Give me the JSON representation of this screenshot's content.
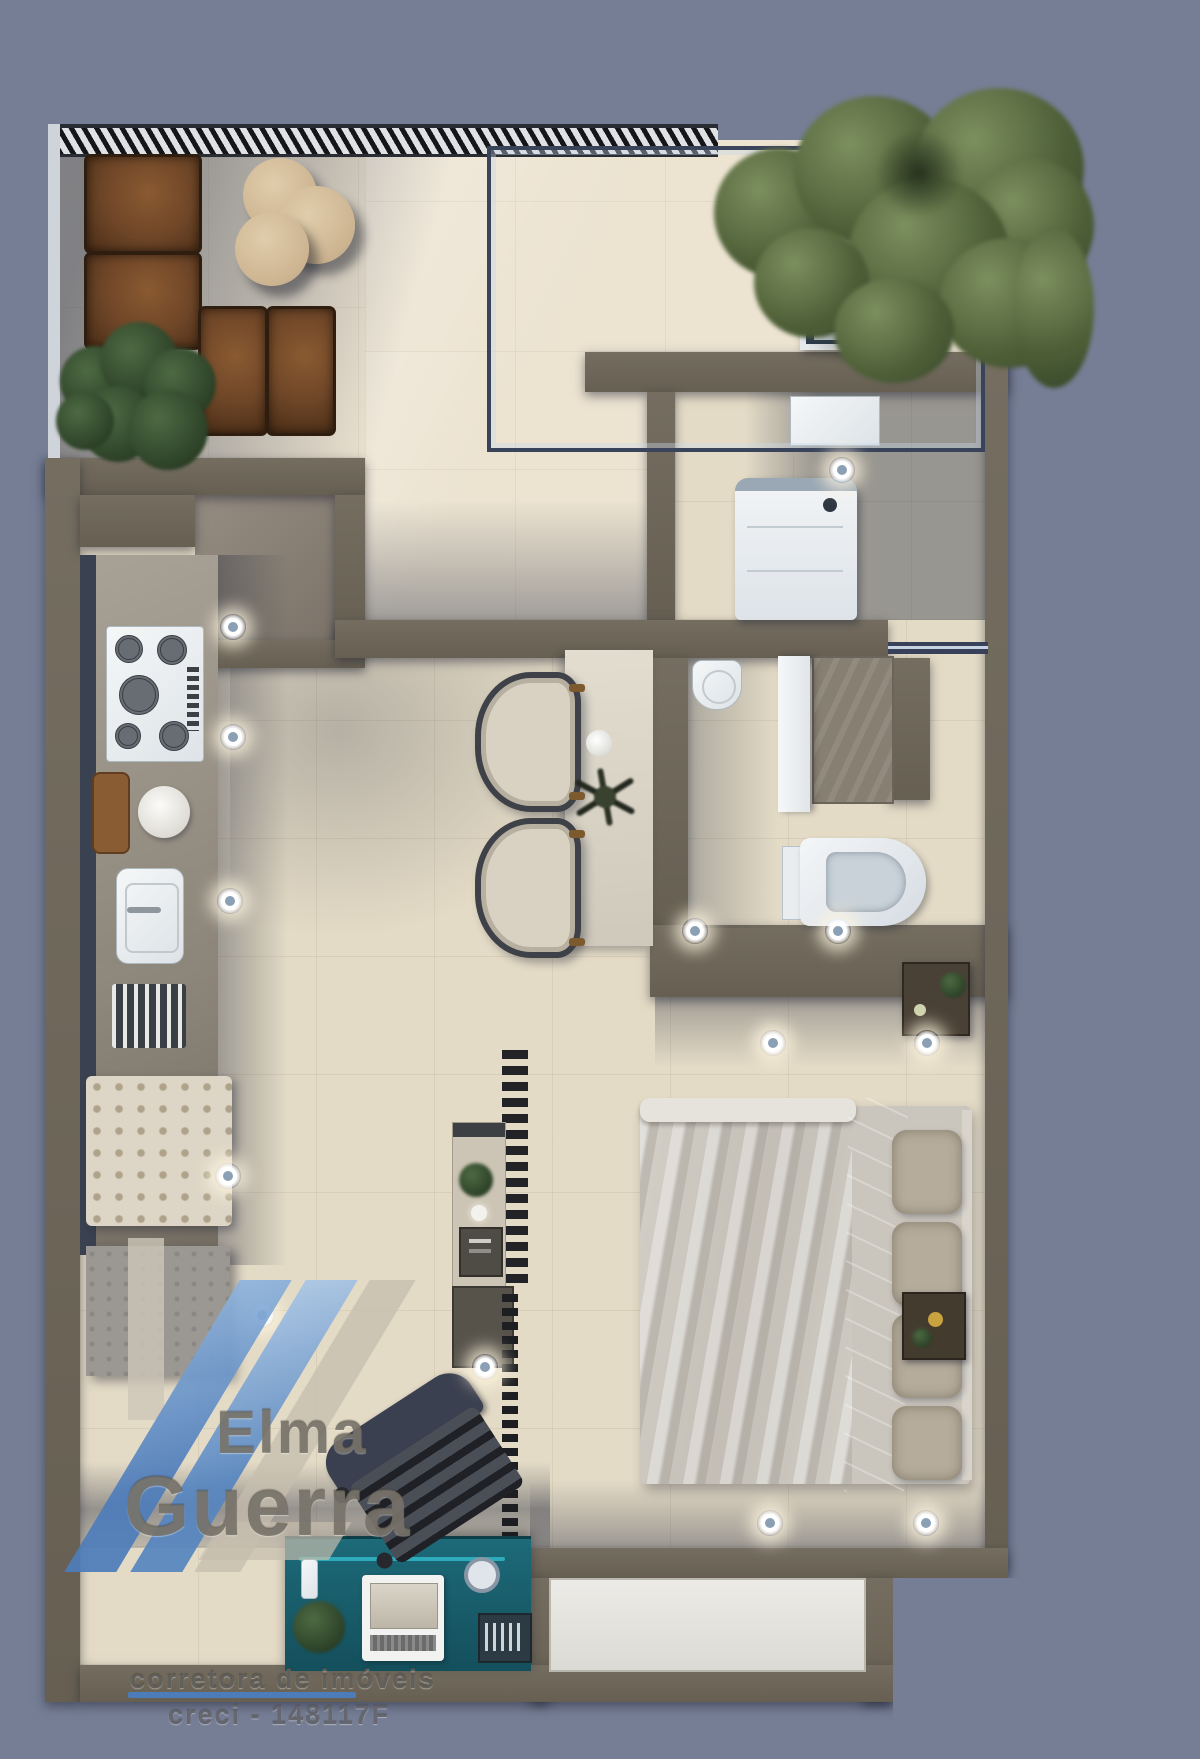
{
  "watermark": {
    "brand_top": "Elma",
    "brand_bottom": "Guerra",
    "tagline": "corretora de imóveis",
    "license": "creci - 148117F"
  },
  "palette": {
    "background": "#757e95",
    "balcony_floor": "#ece3d1",
    "interior_floor": "#e4dbc6",
    "wall": "#6e6759",
    "wall_dark": "#3a4150",
    "kitchen_counter": "#9c9487",
    "entry_floor": "#8c8377",
    "sofa_leather": "#6d4527",
    "plant_green": "#3c5134",
    "tree_green": "#55663f",
    "furniture_white": "#eef0f1",
    "desk_teal": "#175f6e",
    "glass_frame": "#39435a",
    "watermark_blue": "#4d7cba",
    "light_glow": "#fff6e0"
  },
  "decor": {
    "lights": [
      [
        233,
        627
      ],
      [
        233,
        737
      ],
      [
        230,
        901
      ],
      [
        228,
        1176
      ],
      [
        262,
        1315
      ],
      [
        842,
        470
      ],
      [
        695,
        931
      ],
      [
        838,
        931
      ],
      [
        773,
        1043
      ],
      [
        927,
        1043
      ],
      [
        770,
        1523
      ],
      [
        926,
        1523
      ],
      [
        485,
        1367
      ]
    ]
  },
  "scene": {
    "areas": [
      "balcony",
      "kitchen",
      "laundry",
      "bathroom",
      "living-dining",
      "bedroom",
      "home-office"
    ]
  }
}
